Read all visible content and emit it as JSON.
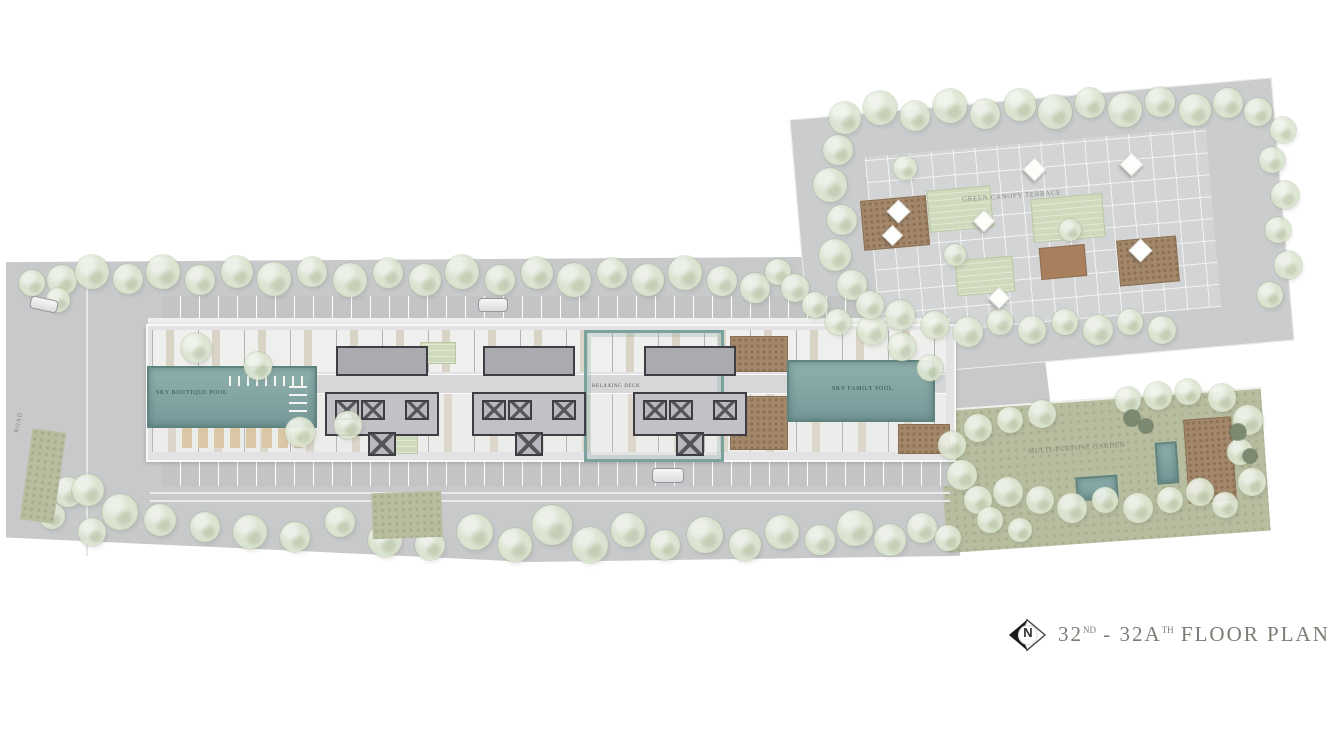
{
  "title_block": {
    "compass_label": "N",
    "floor_from": "32",
    "floor_from_sup": "ND",
    "separator": " - ",
    "floor_to": "32A",
    "floor_to_sup": "TH",
    "suffix": " FLOOR PLAN"
  },
  "labels": {
    "left_pool": "SKY BOUTIQUE POOL",
    "right_pool": "SKY FAMILY POOL",
    "relaxing_deck": "RELAXING DECK",
    "terrace": "GREEN CANOPY TERRACE",
    "garden": "MULTI-PURPOSE GARDEN",
    "road": "ROAD"
  },
  "colors": {
    "pool_teal": "#7fa3a0",
    "pool_border": "#5e8480",
    "tree_green": "#dde6d2",
    "tree_edge": "#c6d4b2",
    "paving_gray": "#c8c9cb",
    "lawn_olive": "#b9bda0",
    "deck_brown": "#9d8164",
    "core_line": "#3d3d43",
    "title_text": "#7c7c74"
  }
}
